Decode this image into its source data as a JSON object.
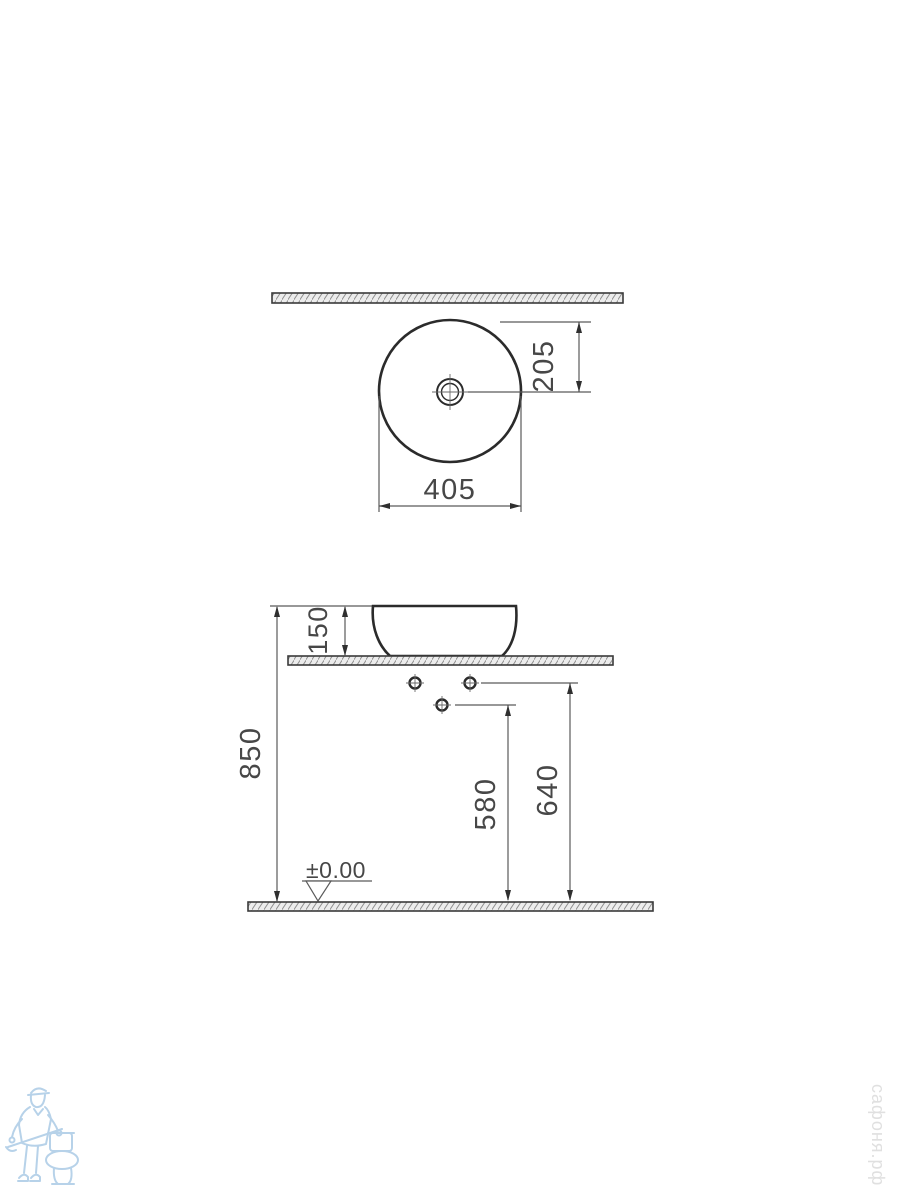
{
  "drawing": {
    "title": "countertop-basin-installation-dimensions",
    "top_view": {
      "diameter": "405",
      "drain_offset": "205"
    },
    "side_view": {
      "basin_height": "150",
      "counter_height": "850",
      "lower_hole_height": "580",
      "upper_hole_height": "640",
      "floor_level": "±0.00"
    }
  },
  "watermark": {
    "site_text": "сафоня.рф"
  },
  "logo": {
    "name": "plumber-with-toilet-mascot"
  },
  "colors": {
    "outline": "#2b2b2b",
    "dimension_line": "#5a5a5a",
    "dimension_text": "#474747",
    "hatch_fill": "#ececec",
    "hatch_line": "#8f8f8f",
    "logo_blue": "#b7d2e9",
    "watermark_gray": "#e0e0e0"
  }
}
